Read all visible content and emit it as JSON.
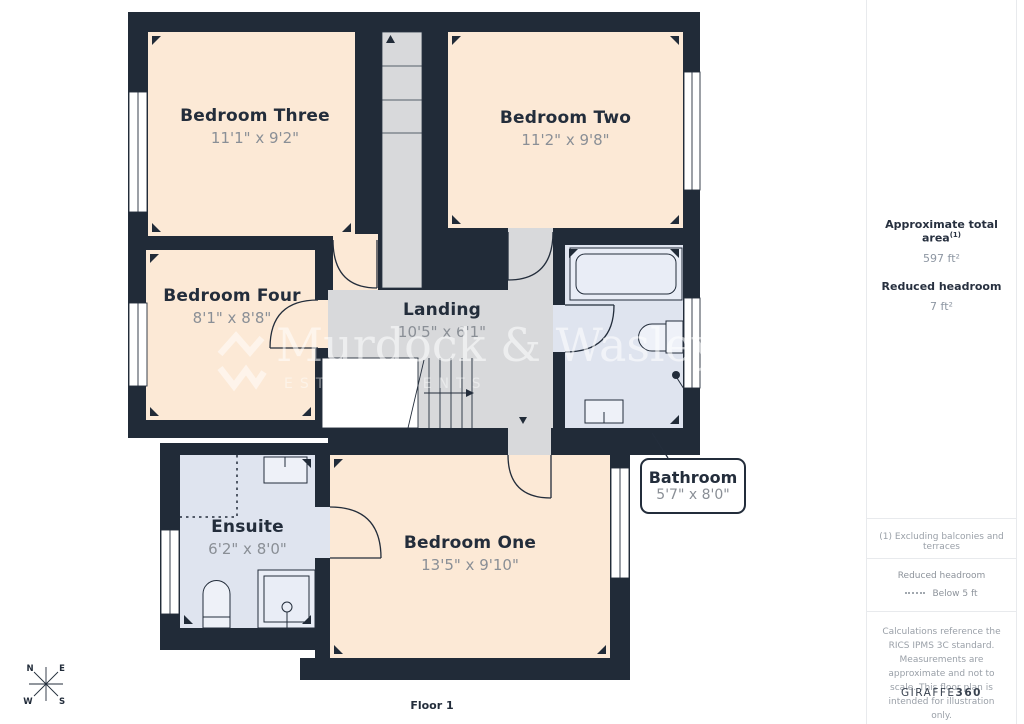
{
  "plan": {
    "floor_label": "Floor 1",
    "rooms": {
      "bedroom_three": {
        "name": "Bedroom Three",
        "dims": "11'1\" x 9'2\""
      },
      "bedroom_two": {
        "name": "Bedroom Two",
        "dims": "11'2\" x 9'8\""
      },
      "bedroom_four": {
        "name": "Bedroom Four",
        "dims": "8'1\" x 8'8\""
      },
      "landing": {
        "name": "Landing",
        "dims": "10'5\" x 6'1\""
      },
      "bathroom": {
        "name": "Bathroom",
        "dims": "5'7\" x 8'0\""
      },
      "ensuite": {
        "name": "Ensuite",
        "dims": "6'2\" x 8'0\""
      },
      "bedroom_one": {
        "name": "Bedroom One",
        "dims": "13'5\" x 9'10\""
      }
    },
    "compass": {
      "n": "N",
      "e": "E",
      "s": "S",
      "w": "W"
    }
  },
  "watermark": {
    "name": "Murdock & Wasley",
    "subtitle": "ESTATE AGENTS"
  },
  "sidebar": {
    "approx_area_label": "Approximate total area",
    "approx_area_sup": "(1)",
    "approx_area_value": "597 ft²",
    "reduced_headroom_label": "Reduced headroom",
    "reduced_headroom_value": "7 ft²",
    "footnote": "(1) Excluding balconies and terraces",
    "legend_title": "Reduced headroom",
    "legend_item": "Below 5 ft",
    "disclaimer": "Calculations reference the RICS IPMS 3C standard. Measurements are approximate and not to scale. This floor plan is intended for illustration only.",
    "brand_name": "GIRAFFE",
    "brand_suffix": "360"
  },
  "colors": {
    "wall": "#212b38",
    "bedroom_fill": "#fce9d6",
    "landing_fill": "#d8d9db",
    "wet_room_fill": "#dfe4ef",
    "dim_text": "#8a8f96",
    "callout_border": "#232d3b"
  }
}
